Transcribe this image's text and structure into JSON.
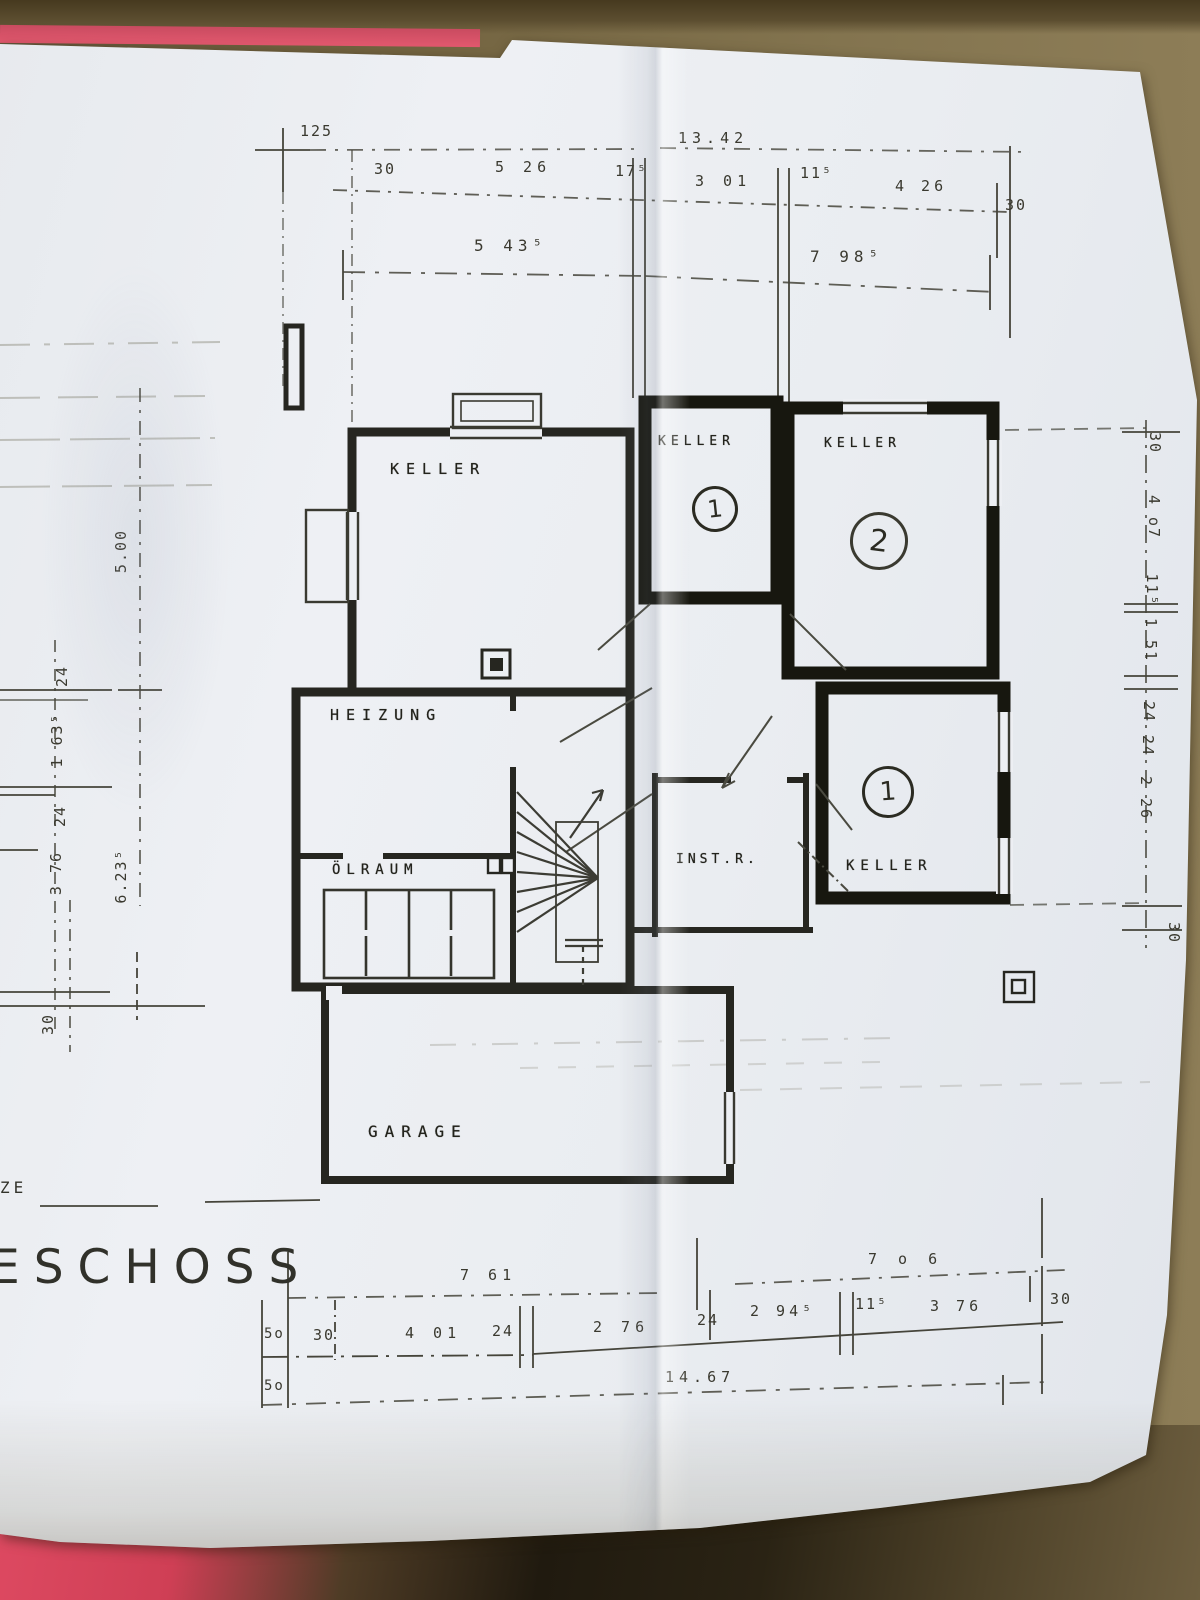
{
  "colors": {
    "background_tan": "#7b6b4a",
    "folder_pink": "#e2586e",
    "paper": "#edeff3",
    "ink": "#2b2b24"
  },
  "plan": {
    "rooms": {
      "keller_left": {
        "label": "KELLER"
      },
      "keller_top": {
        "label": "KELLER",
        "number": "1"
      },
      "keller_right": {
        "label": "KELLER",
        "number": "2"
      },
      "keller_lower": {
        "label": "KELLER",
        "number": "1"
      },
      "heizung": {
        "label": "HEIZUNG"
      },
      "oelraum": {
        "label": "ÖLRAUM"
      },
      "inst_r": {
        "label": "INST.R."
      },
      "garage": {
        "label": "GARAGE"
      }
    }
  },
  "dims": {
    "top_row1": [
      "125",
      "13.42"
    ],
    "top_row2": [
      "30",
      "5 26",
      "17⁵",
      "3 01",
      "11⁵",
      "4 26",
      "30"
    ],
    "top_totals": [
      "5 43⁵",
      "7 98⁵"
    ],
    "bottom_totals": [
      "7 61",
      "7 o 6"
    ],
    "bottom_row": [
      "5o",
      "30",
      "4 01",
      "24",
      "2 76",
      "24",
      "2 94⁵",
      "11⁵",
      "3 76",
      "30"
    ],
    "bottom_overall": [
      "5o",
      "14.67"
    ],
    "left_col": [
      "5.00",
      "24",
      "1 63⁵",
      "24",
      "3 76",
      "6.23⁵",
      "30"
    ],
    "right_col": [
      "30",
      "4 o7",
      "11⁵",
      "1 51",
      "24",
      "24",
      "2 26",
      "30"
    ]
  },
  "fragments": {
    "floor_title": "ESCHOSS",
    "left_edge": "ZE"
  }
}
